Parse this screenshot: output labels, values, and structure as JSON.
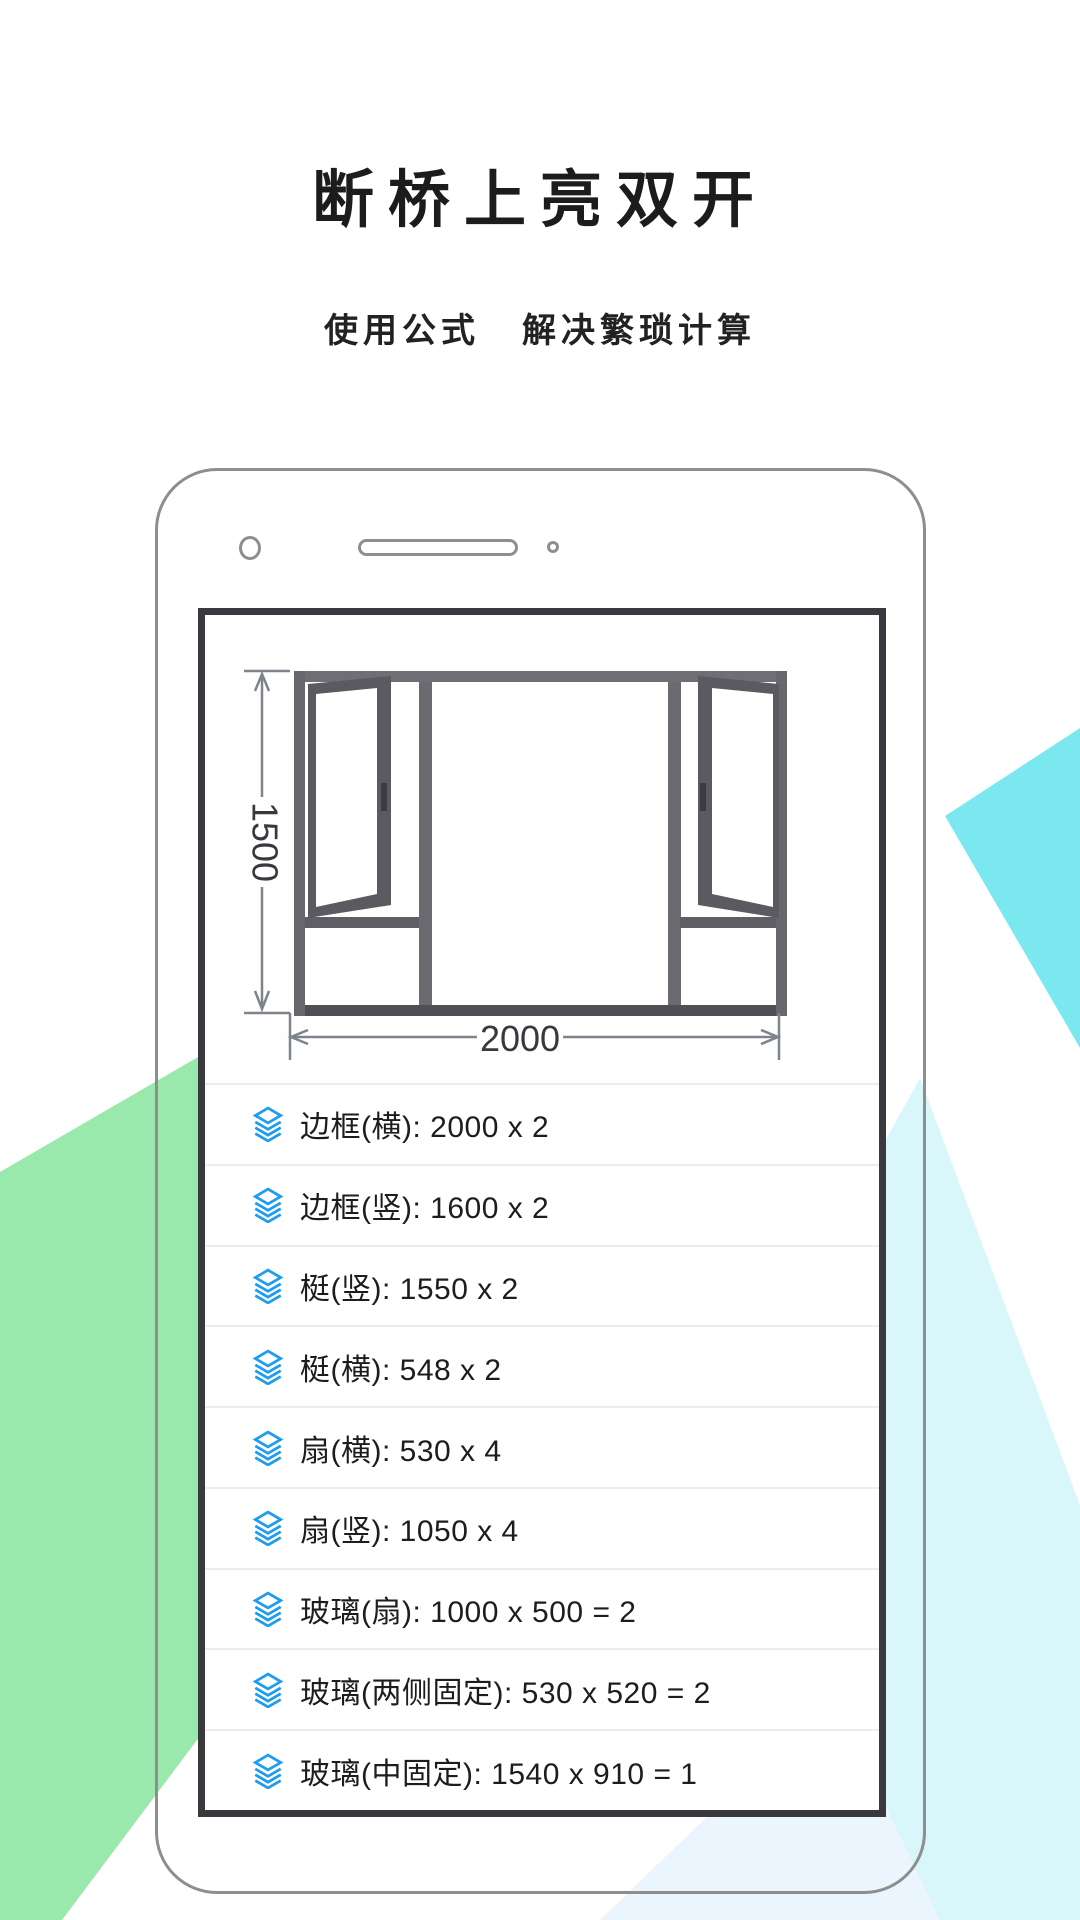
{
  "hero": {
    "title": "断桥上亮双开",
    "subtitle_left": "使用公式",
    "subtitle_right": "解决繁琐计算"
  },
  "diagram": {
    "height_label": "1500",
    "width_label": "2000"
  },
  "list": {
    "rows": [
      {
        "icon": "layers-icon",
        "text": "边框(横): 2000 x 2"
      },
      {
        "icon": "layers-icon",
        "text": "边框(竖): 1600 x 2"
      },
      {
        "icon": "layers-icon",
        "text": "梃(竖): 1550 x 2"
      },
      {
        "icon": "layers-icon",
        "text": "梃(横): 548 x 2"
      },
      {
        "icon": "layers-icon",
        "text": "扇(横): 530 x 4"
      },
      {
        "icon": "layers-icon",
        "text": "扇(竖): 1050 x 4"
      },
      {
        "icon": "layers-icon",
        "text": "玻璃(扇): 1000 x 500 = 2"
      },
      {
        "icon": "layers-icon",
        "text": "玻璃(两侧固定): 530 x 520 = 2"
      },
      {
        "icon": "layers-icon",
        "text": "玻璃(中固定): 1540 x 910 = 1"
      }
    ]
  },
  "colors": {
    "accent_blue": "#1E9CEF",
    "text_dark": "#1D1D1F",
    "shape_green": "#99E9AC",
    "shape_cyan_bright": "#7BE8F0",
    "shape_cyan_pale": "#D9F6FB",
    "shape_blue_palest": "#EAF5FD",
    "phone_border": "#8E8E8E",
    "screen_border": "#3A3A3E",
    "separator": "#ECECF1",
    "dim_line": "#7D848C"
  }
}
